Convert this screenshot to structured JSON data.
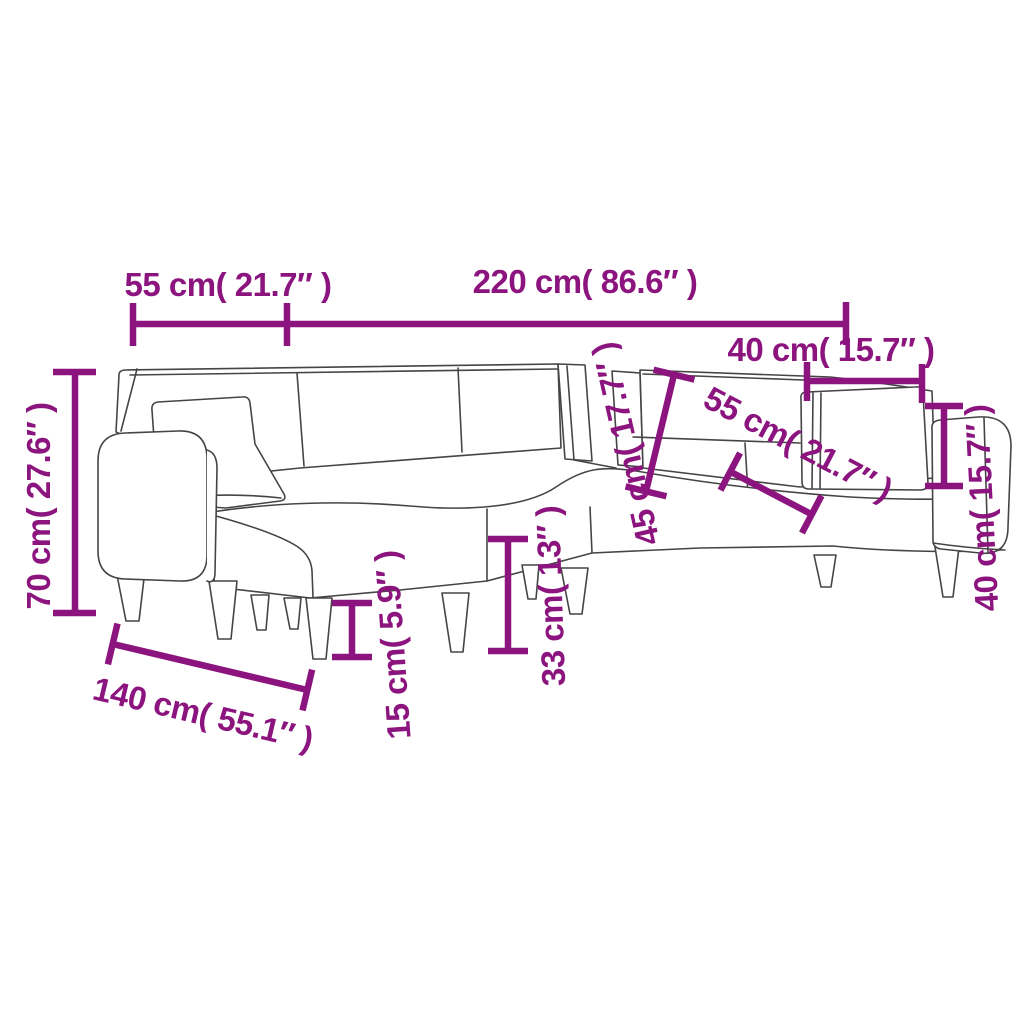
{
  "page": {
    "background": "#ffffff"
  },
  "diagram": {
    "subject": "L-shaped sofa bed with pillows - dimension drawing",
    "accent_color": "#8c147e",
    "outline_color": "#454545",
    "dimensions": [
      {
        "id": "top-left-width",
        "label": "55 cm( 21.7″ )",
        "cm": 55,
        "inches": 21.7
      },
      {
        "id": "top-overall-length",
        "label": "220 cm( 86.6″ )",
        "cm": 220,
        "inches": 86.6
      },
      {
        "id": "top-right-pillow-width",
        "label": "40 cm( 15.7″ )",
        "cm": 40,
        "inches": 15.7
      },
      {
        "id": "left-overall-height",
        "label": "70 cm( 27.6″ )",
        "cm": 70,
        "inches": 27.6
      },
      {
        "id": "mid-backrest-height",
        "label": "45 cm( 17.7″ )",
        "cm": 45,
        "inches": 17.7
      },
      {
        "id": "diagonal-seat-depth",
        "label": "55 cm( 21.7″ )",
        "cm": 55,
        "inches": 21.7
      },
      {
        "id": "right-pillow-height",
        "label": "40 cm( 15.7″ )",
        "cm": 40,
        "inches": 15.7
      },
      {
        "id": "bottom-chaise-length",
        "label": "140 cm( 55.1″ )",
        "cm": 140,
        "inches": 55.1
      },
      {
        "id": "leg-height",
        "label": "15 cm( 5.9″ )",
        "cm": 15,
        "inches": 5.9
      },
      {
        "id": "seat-height",
        "label": "33 cm( 13″ )",
        "cm": 33,
        "inches": 13
      }
    ]
  }
}
